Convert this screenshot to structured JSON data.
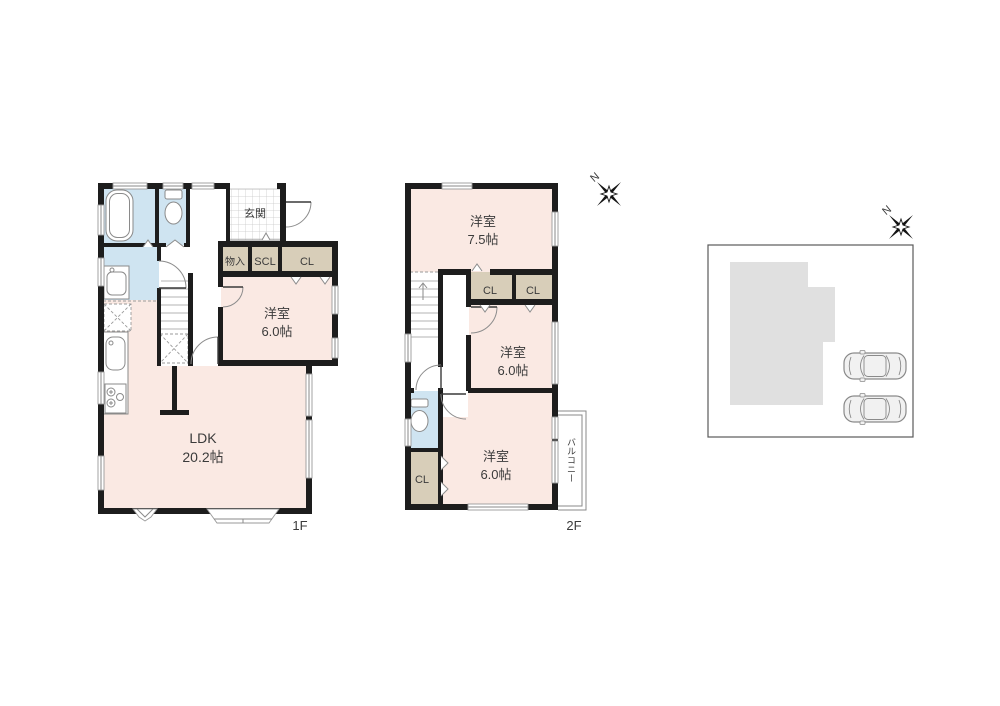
{
  "colors": {
    "wall": "#1d1d1d",
    "room_pink": "#fae9e3",
    "closet_tan": "#d8ceb9",
    "water_blue": "#cfe4f1",
    "building_gray": "#e0e0e0",
    "line_gray": "#8a8a8a",
    "text": "#3b3b3b"
  },
  "floor1": {
    "floor_label": "1F",
    "entrance": "玄関",
    "storage": "物入",
    "shoe_closet": "SCL",
    "closet": "CL",
    "bedroom": {
      "name": "洋室",
      "size": "6.0帖"
    },
    "ldk": {
      "name": "LDK",
      "size": "20.2帖"
    }
  },
  "floor2": {
    "floor_label": "2F",
    "bedroom_a": {
      "name": "洋室",
      "size": "7.5帖"
    },
    "closet_a": "CL",
    "closet_b": "CL",
    "closet_c": "CL",
    "bedroom_b": {
      "name": "洋室",
      "size": "6.0帖"
    },
    "bedroom_c": {
      "name": "洋室",
      "size": "6.0帖"
    },
    "balcony": "バルコニー"
  },
  "compass": {
    "north": "N"
  }
}
